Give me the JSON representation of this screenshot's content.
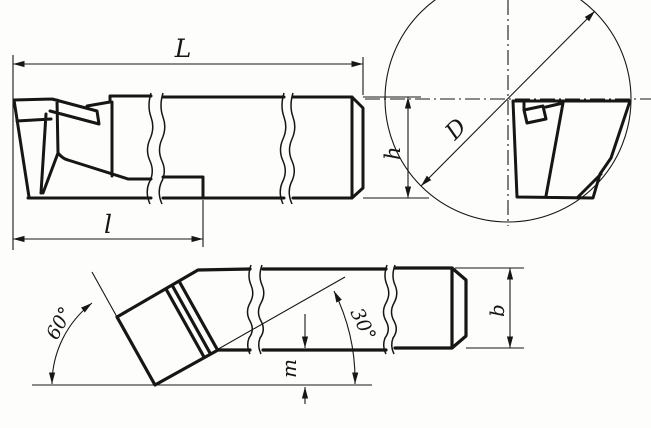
{
  "page": {
    "background_color": "#fdfdfc",
    "line_color": "#161616",
    "description_labels_only": "technical drawing of a bent boring cutter, three views, no other text"
  },
  "drawing": {
    "side_view": {
      "total_length": "L",
      "head_length": "l",
      "shank_height": "h"
    },
    "end_view": {
      "bore_diameter": "D"
    },
    "plan_view": {
      "lead_angle": "60°",
      "bend_angle": "30°",
      "tip_offset": "m",
      "shank_width": "b"
    }
  }
}
